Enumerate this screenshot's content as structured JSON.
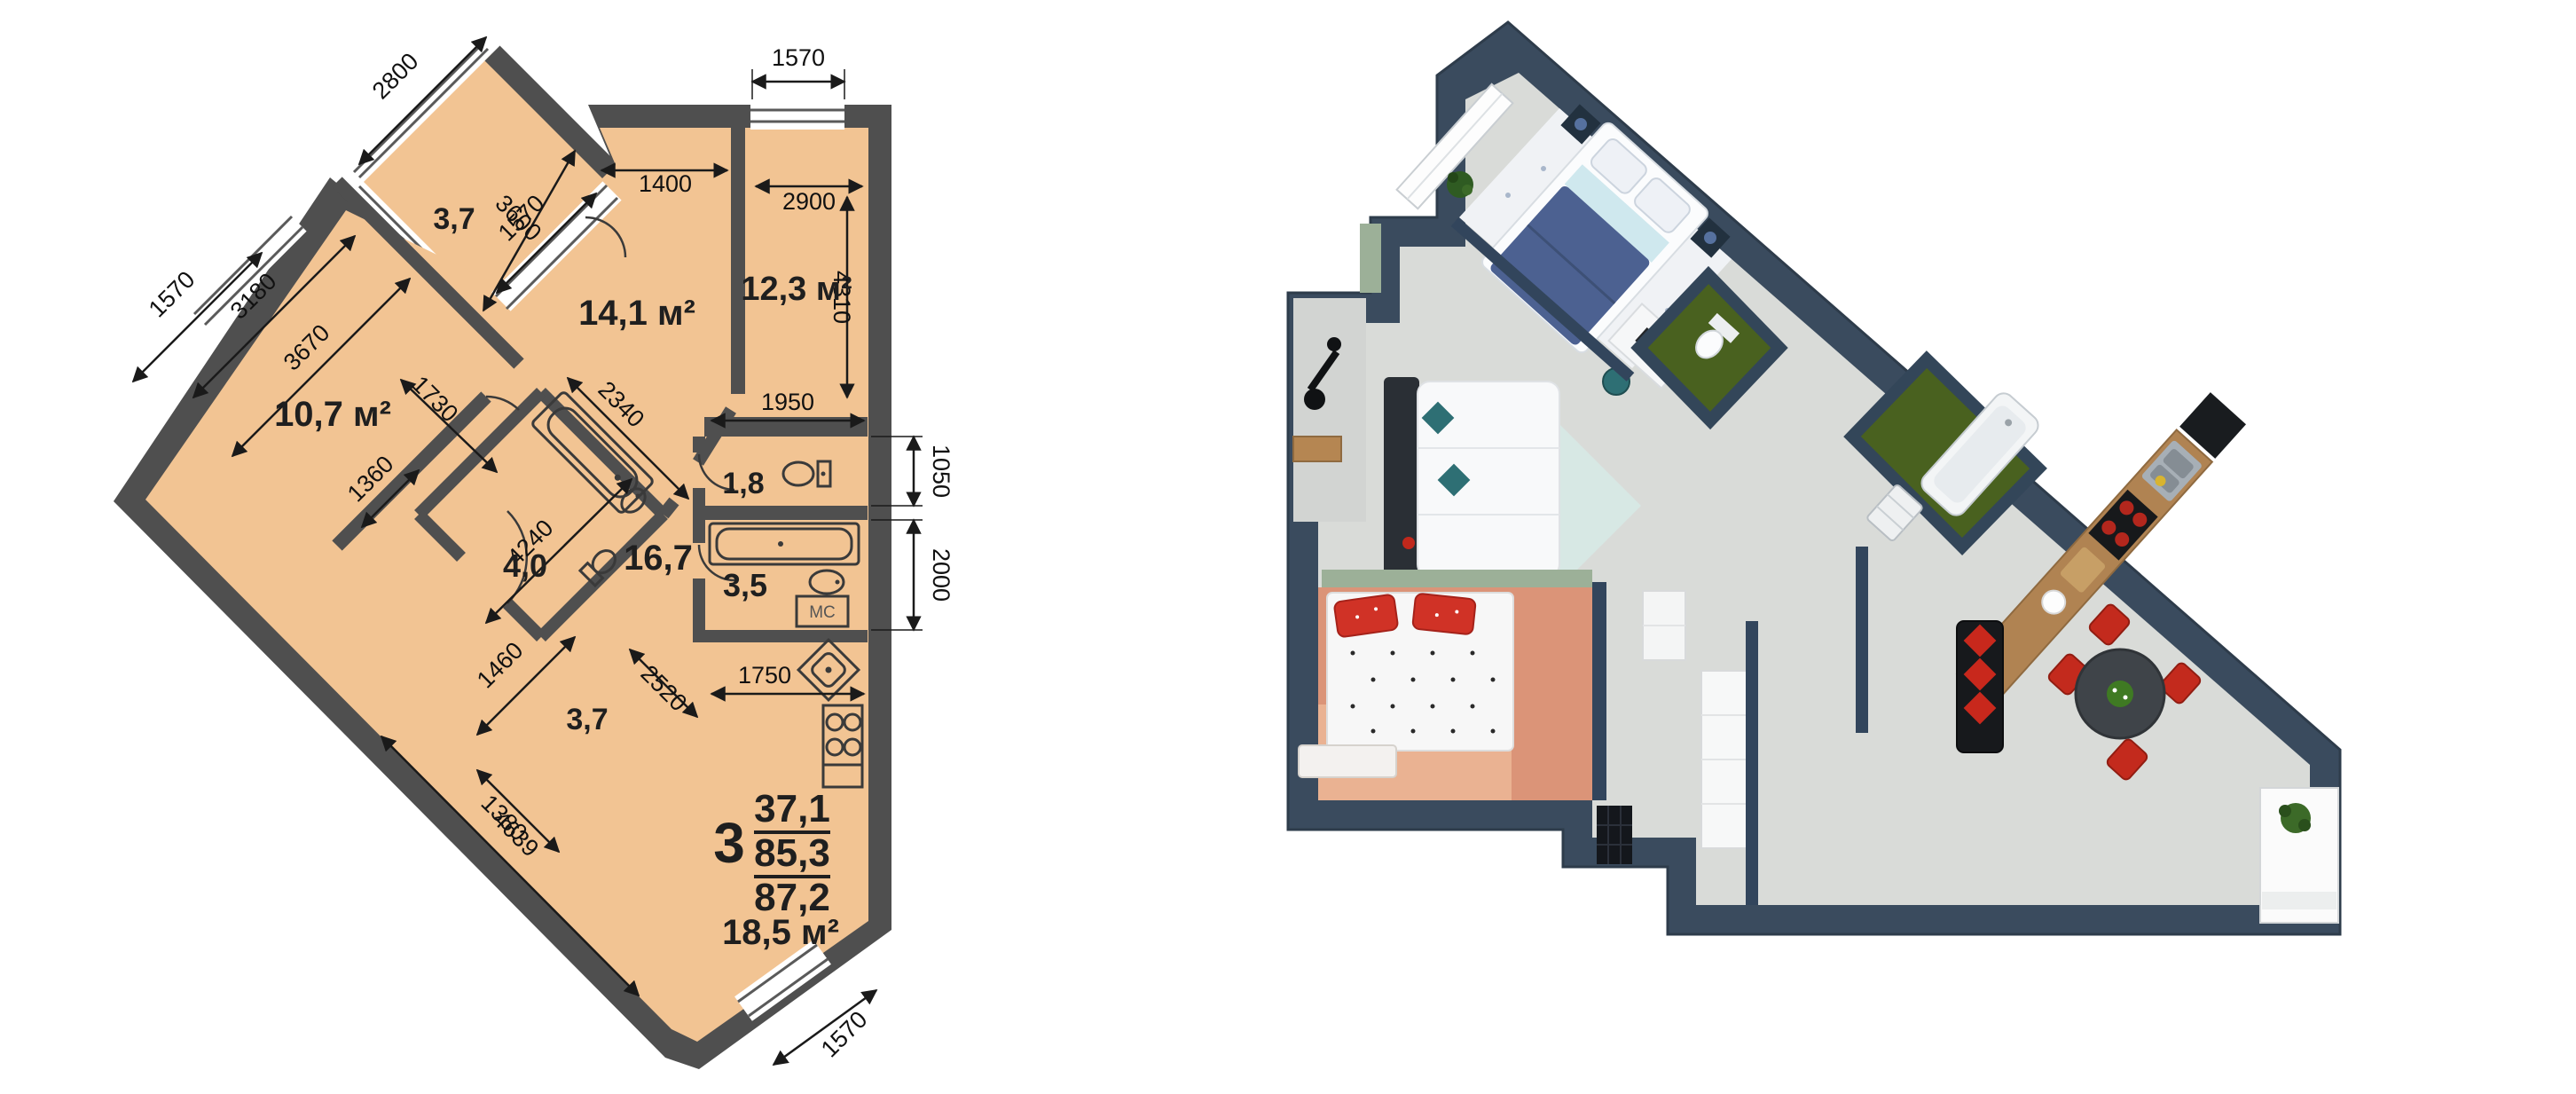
{
  "colors": {
    "floor_2d": "#F2C493",
    "wall_2d": "#4F4F4F",
    "ink": "#1A1A1A",
    "wall_3d": "#3A4B5E",
    "floor_3d": "#D9DBD8",
    "salmon_floor": "#DB9478",
    "grass_floor": "#49611F",
    "wood": "#B08352",
    "navy_duvet": "#4C6191",
    "teal": "#2E6F74",
    "red": "#C8281C",
    "sage": "#9CB098"
  },
  "plan2d": {
    "rooms": {
      "balcony_top": "3,7",
      "bedroom1": "14,1 м²",
      "bedroom2": "12,3 м²",
      "bedroom3": "10,7 м²",
      "bathroom": "4,0",
      "wc": "1,8",
      "hall": "16,7",
      "bathroom2": "3,5",
      "balcony_lower": "3,7",
      "kitchen_living": "18,5 м²"
    },
    "fixtures": {
      "washing_machine": "МС"
    },
    "summary": {
      "rooms_count": "3",
      "living_area": "37,1",
      "usable_area": "85,3",
      "total_area": "87,2"
    },
    "dims": {
      "balcony_top_width": "2800",
      "balcony_top_window": "1570",
      "bedroom1_top": "1400",
      "bedroom2_window": "1570",
      "bedroom2_width": "2900",
      "bedroom1_diag": "3600",
      "bedroom2_height": "4310",
      "bedroom3_window": "1570",
      "bedroom3_w1": "3180",
      "bedroom3_w2": "3670",
      "niche_below_bedroom2": "1950",
      "bathroom_w": "1730",
      "bathroom_l": "2340",
      "wc_height": "1050",
      "bathroom2_height": "2000",
      "hall_door": "1360",
      "hall_length": "4240",
      "balcony_lower_w": "1460",
      "balcony_lower_l": "2520",
      "balcony_lower_b": "1380",
      "kitchen_niche": "1750",
      "kitchen_diag": "4639",
      "kitchen_window": "1570"
    }
  }
}
